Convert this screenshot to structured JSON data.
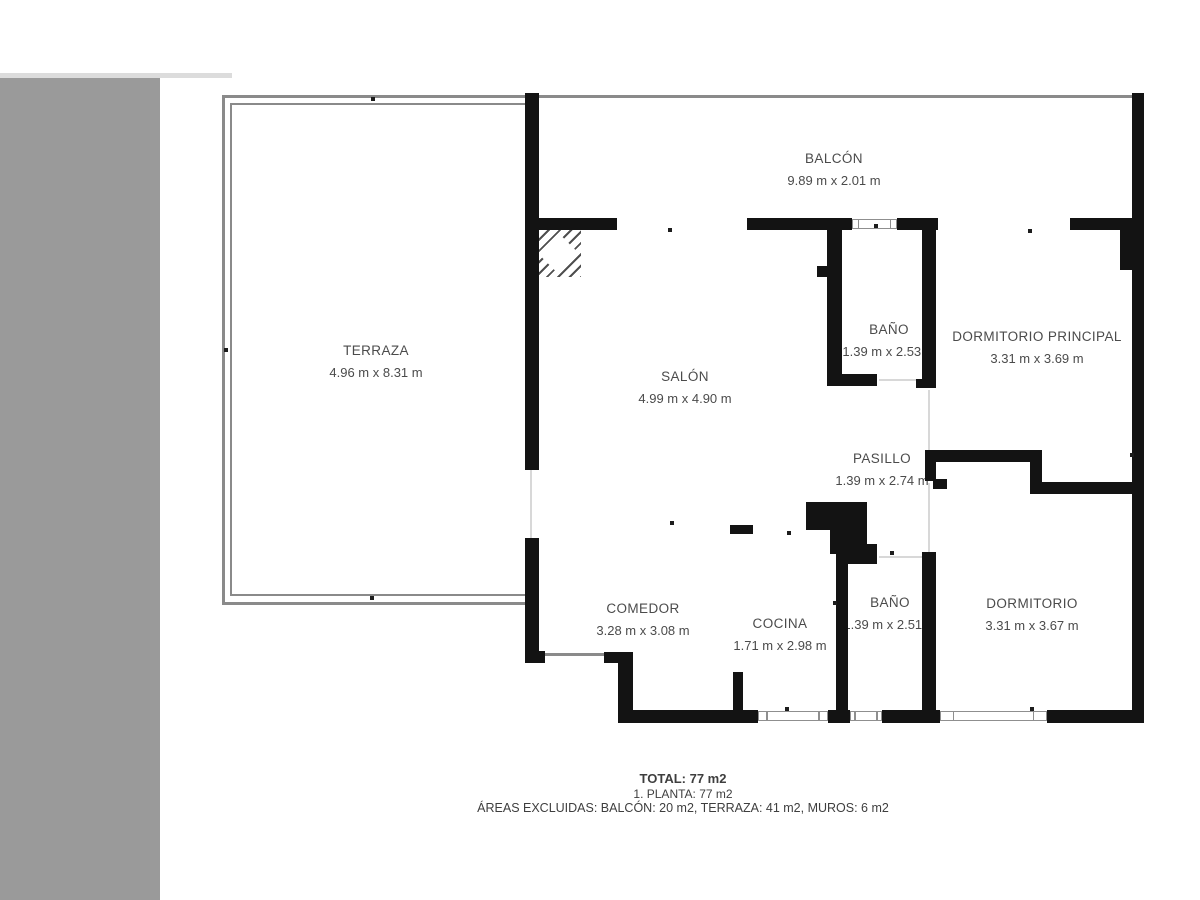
{
  "plan": {
    "wall_color": "#131313",
    "railing_color": "#8a8a8a",
    "rooms": {
      "balcon": {
        "name": "BALCÓN",
        "dims": "9.89 m x 2.01 m"
      },
      "terraza": {
        "name": "TERRAZA",
        "dims": "4.96 m x 8.31 m"
      },
      "salon": {
        "name": "SALÓN",
        "dims": "4.99 m x 4.90 m"
      },
      "bano1": {
        "name": "BAÑO",
        "dims": "1.39 m x 2.53 m"
      },
      "dormitorio_principal": {
        "name": "DORMITORIO PRINCIPAL",
        "dims": "3.31 m x 3.69 m"
      },
      "pasillo": {
        "name": "PASILLO",
        "dims": "1.39 m x 2.74 m"
      },
      "comedor": {
        "name": "COMEDOR",
        "dims": "3.28 m x 3.08 m"
      },
      "cocina": {
        "name": "COCINA",
        "dims": "1.71 m x 2.98 m"
      },
      "bano2": {
        "name": "BAÑO",
        "dims": "1.39 m x 2.51 m"
      },
      "dormitorio": {
        "name": "DORMITORIO",
        "dims": "3.31 m x 3.67 m"
      }
    }
  },
  "sidebar": {
    "color": "#9a9a9a"
  },
  "summary": {
    "total": "TOTAL: 77 m2",
    "floor": "1. PLANTA: 77 m2",
    "excluded": "ÁREAS EXCLUIDAS: BALCÓN: 20 m2, TERRAZA: 41 m2, MUROS: 6 m2"
  }
}
